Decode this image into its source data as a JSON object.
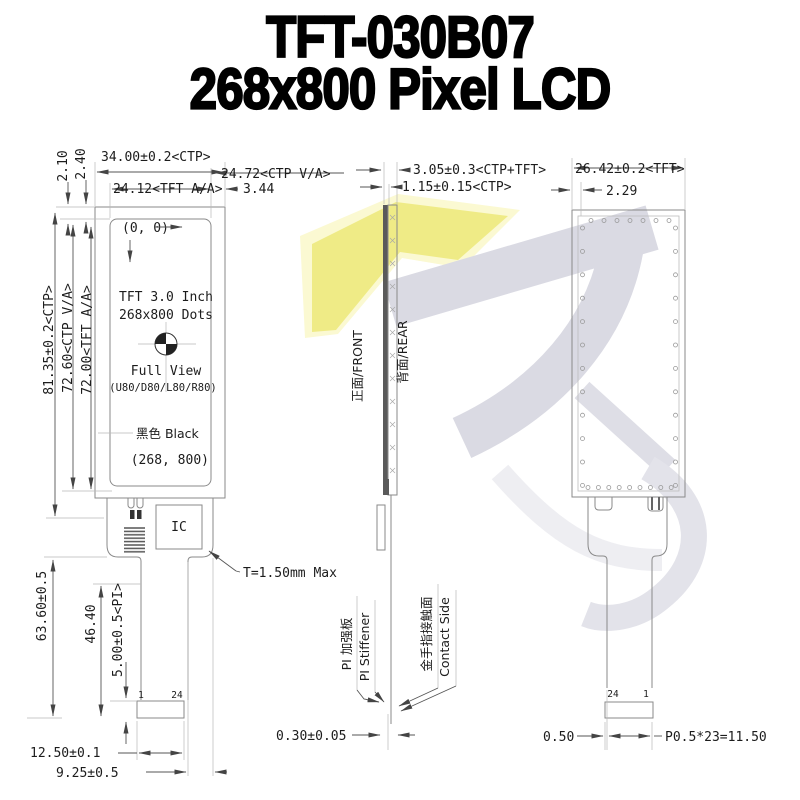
{
  "title": {
    "line1": "TFT-030B07",
    "line2": "268x800 Pixel LCD"
  },
  "front": {
    "origin": "(0, 0)",
    "spec1": "TFT 3.0 Inch",
    "spec2": "268x800 Dots",
    "spec3": "Full View",
    "spec4": "(U80/D80/L80/R80)",
    "color": "黑色 Black",
    "corner": "(268, 800)",
    "ic": "IC",
    "thickness": "T=1.50mm Max",
    "pin_first": "1",
    "pin_last": "24",
    "dim_width_ctp": "34.00±0.2<CTP>",
    "dim_width_ctp_va": "24.72<CTP V/A>",
    "dim_width_tft_aa": "24.12<TFT A/A>",
    "dim_edge_right": "3.44",
    "dim_top_a": "2.40",
    "dim_top_b": "2.10",
    "dim_h_tft_aa": "72.00<TFT A/A>",
    "dim_h_ctp_va": "72.60<CTP V/A>",
    "dim_h_ctp": "81.35±0.2<CTP>",
    "dim_tail_total": "63.60±0.5",
    "dim_tail_mid": "46.40",
    "dim_pi": "5.00±0.5<PI>",
    "dim_conn_w": "12.50±0.1",
    "dim_conn_off": "9.25±0.5"
  },
  "side": {
    "front_label": "正面/FRONT",
    "rear_label": "背面/REAR",
    "dim_total": "3.05±0.3<CTP+TFT>",
    "dim_ctp": "1.15±0.15<CTP>",
    "dim_fpc": "0.30±0.05",
    "stiffener_cn": "PI 加强板",
    "stiffener_en": "PI Stiffener",
    "contact_cn": "金手指接触面",
    "contact_en": "Contact Side"
  },
  "rear": {
    "dim_width": "26.42±0.2<TFT>",
    "dim_edge": "2.29",
    "dim_gap": "0.50",
    "dim_pitch": "P0.5*23=11.50",
    "pin_left": "24",
    "pin_right": "1"
  }
}
